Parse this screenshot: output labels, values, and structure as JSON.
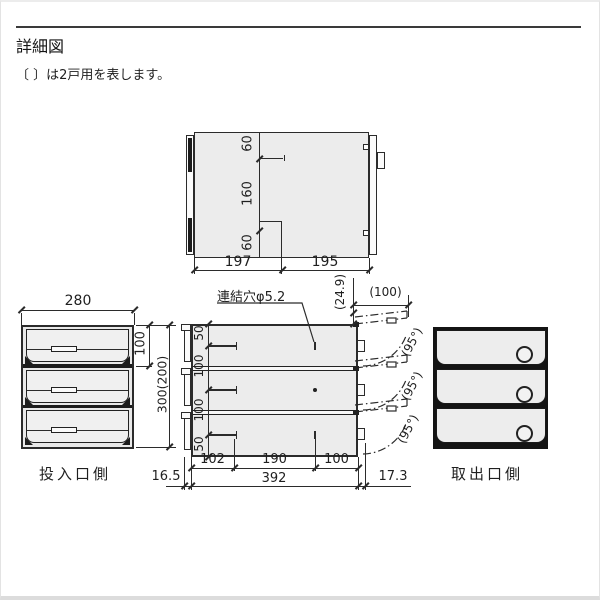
{
  "page": {
    "title": "詳細図",
    "note": "〔 〕は2戸用を表します。"
  },
  "top_view": {
    "v_dims": [
      "60",
      "160",
      "60"
    ],
    "h_dims": [
      "197",
      "195"
    ]
  },
  "left_view": {
    "width_dim": "280",
    "tier_dim": "100",
    "height_dim": "300(200)",
    "label": "投入口側"
  },
  "center_view": {
    "hole_label": "連結穴φ5.2",
    "rise_dim": "(24.9)",
    "door_open_dim": "(100)",
    "left_dims": [
      "50",
      "100",
      "100",
      "50"
    ],
    "angle_dims": [
      "(95°)",
      "(95°)",
      "(95°)"
    ],
    "bottom_dims": [
      "102",
      "190",
      "100"
    ],
    "total_width_dim": "392",
    "left_offset_dim": "16.5",
    "right_offset_dim": "17.3"
  },
  "right_view": {
    "label": "取出口側"
  },
  "colors": {
    "line": "#2b2b2b",
    "panel_fill": "#ececec",
    "dark": "#1a1a1a",
    "background": "#ffffff"
  }
}
